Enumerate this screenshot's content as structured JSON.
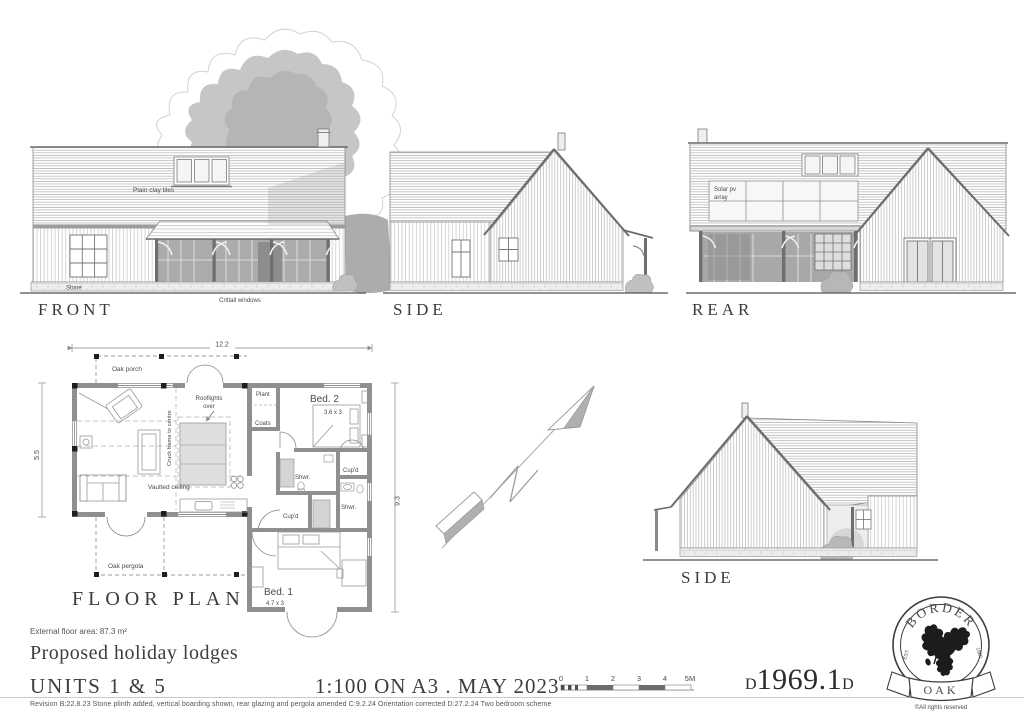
{
  "sheet": {
    "project_title": "Proposed holiday lodges",
    "floor_area": "External floor area: 87.3 m²",
    "units": "UNITS 1 & 5",
    "scale_date": "1:100 ON A3 . MAY 2023",
    "revision": "Revision B:22.8.23 Stone plinth added, vertical boarding shown, rear glazing and pergola amended  C:9.2.24 Orientation corrected  D:27.2.24 Two bedroom scheme",
    "drawing_number": {
      "prefix": "D",
      "number": "1969.1",
      "suffix": "D"
    }
  },
  "elevations": {
    "front": {
      "title": "FRONT",
      "roof_note": "Plain clay tiles",
      "plinth_note": "Stone",
      "window_note": "Crittall windows"
    },
    "side_upper": {
      "title": "SIDE"
    },
    "rear": {
      "title": "REAR",
      "solar_note_line1": "Solar pv",
      "solar_note_line2": "array"
    },
    "side_lower": {
      "title": "SIDE"
    }
  },
  "floor_plan": {
    "title": "FLOOR PLAN",
    "dims": {
      "width": "12.2",
      "depth_left": "5.5",
      "depth_right": "9.3"
    },
    "labels": {
      "oak_porch": "Oak porch",
      "oak_pergola": "Oak pergola",
      "plant": "Plant",
      "coats": "Coats",
      "bed2": "Bed. 2",
      "bed2_size": "3.6 x 3",
      "bed1": "Bed. 1",
      "bed1_size": "4.7 x 3",
      "shwr1": "Shwr.",
      "shwr2": "Shwr.",
      "cupd1": "Cup'd",
      "cupd2": "Cup'd",
      "rooflights_line1": "Rooflights",
      "rooflights_line2": "over",
      "vaulted": "Vaulted ceiling",
      "cruck": "Cruck frame to centre"
    }
  },
  "scale_bar": {
    "ticks": [
      "0",
      "1",
      "2",
      "3",
      "4",
      "5M"
    ]
  },
  "logo": {
    "arc": "BORDER",
    "banner": "OAK",
    "est": "EST.",
    "year": "1980",
    "rights": "©All rights reserved"
  },
  "colors": {
    "wall": "#8f8f8f",
    "glass": "#ababab",
    "shade": "#c5c5c5",
    "ink": "#3b3b3b"
  }
}
